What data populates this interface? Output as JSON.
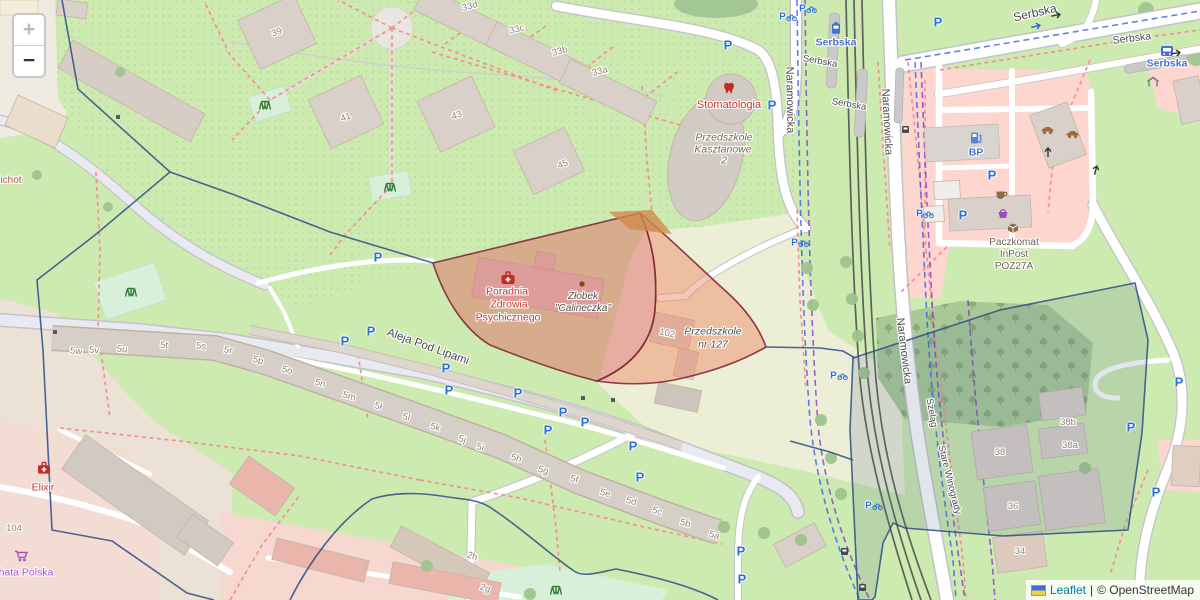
{
  "controls": {
    "zoom_in": "+",
    "zoom_out": "−"
  },
  "attribution": {
    "flag": "ukraine-flag",
    "leaflet": "Leaflet",
    "sep": "|",
    "osm": "© OpenStreetMap"
  },
  "colors": {
    "overlay_red_fill": "#e06666",
    "overlay_red_border": "#82293b",
    "overlay_orange": "#d1894f",
    "boundary_blue": "#2b4d86",
    "boundary_fill": "#5a7290",
    "parking_blue": "#2a6fdb",
    "poi_red": "#c7342e",
    "poi_blue": "#4a6fd0",
    "poi_purple": "#ad4ec1",
    "poi_brown": "#6e6152",
    "edu_text": "#6d6d54",
    "num_text": "#8d8275",
    "street_text": "#4a4a4a",
    "park_green": "#cdebb0",
    "forest_green": "#a9c996",
    "mint_green": "#d8f0da",
    "schoolyard": "#edeed6",
    "building": "#d9d0c9",
    "retail_pink": "#fcd6cf",
    "road_grey": "#e9e9f1",
    "tram_grey": "#5f5f5f",
    "path_red": "#f59090",
    "cycle_blue": "#3355e8",
    "route_purple": "#7733cc",
    "attr_link": "#0078a8"
  },
  "map": {
    "labels": [
      {
        "t": "Aleja Pod Lipami",
        "x": 428,
        "y": 347,
        "r": 20,
        "c": "street",
        "s": 11.5
      },
      {
        "t": "Naramowicka",
        "x": 789,
        "y": 100,
        "r": 89,
        "c": "street"
      },
      {
        "t": "Naramowicka",
        "x": 886,
        "y": 122,
        "r": 87,
        "c": "street"
      },
      {
        "t": "Naramowicka",
        "x": 903,
        "y": 351,
        "r": 83,
        "c": "street"
      },
      {
        "t": "Serbska",
        "x": 1035,
        "y": 13,
        "r": -13,
        "c": "street",
        "s": 12
      },
      {
        "t": "Serbska",
        "x": 1132,
        "y": 39,
        "r": -7,
        "c": "street",
        "s": 10.5
      },
      {
        "t": "Serbska",
        "x": 820,
        "y": 62,
        "r": 10,
        "c": "street",
        "s": 9.5
      },
      {
        "t": "Serbska",
        "x": 849,
        "y": 105,
        "r": 10,
        "c": "street",
        "s": 9.5
      },
      {
        "t": "Szeląg",
        "x": 931,
        "y": 413,
        "r": 80,
        "c": "street",
        "s": 9.5
      },
      {
        "t": "Stare Winogrady",
        "x": 949,
        "y": 480,
        "r": 76,
        "c": "street",
        "s": 9.5
      },
      {
        "t": "Serbska",
        "x": 836,
        "y": 43,
        "r": 0,
        "c": "poi-blue"
      },
      {
        "t": "Serbska",
        "x": 1167,
        "y": 64,
        "r": 0,
        "c": "poi-blue"
      },
      {
        "t": "BP",
        "x": 976,
        "y": 153,
        "r": 0,
        "c": "poi-blue"
      },
      {
        "t": "Stomatologia",
        "x": 729,
        "y": 106,
        "r": 0,
        "c": "poi-red",
        "s": 11
      },
      {
        "t": "ichot",
        "x": 11,
        "y": 181,
        "r": 0,
        "c": "poi-maroon"
      },
      {
        "t": "Elixir",
        "x": 43,
        "y": 488,
        "r": 0,
        "c": "poi-red"
      },
      {
        "t": "hata Polska",
        "x": 26,
        "y": 573,
        "r": 0,
        "c": "poi-purple"
      },
      {
        "t": "Poradnia",
        "x": 507,
        "y": 292,
        "r": 0,
        "c": "overlay-red"
      },
      {
        "t": "Zdrowia",
        "x": 509,
        "y": 305,
        "r": 0,
        "c": "overlay-red"
      },
      {
        "t": "Psychicznego",
        "x": 508,
        "y": 318,
        "r": 0,
        "c": "overlay-red"
      },
      {
        "t": "Żłobek",
        "x": 583,
        "y": 297,
        "r": 0,
        "c": "poi-dark"
      },
      {
        "t": "\"Calineczka\"",
        "x": 583,
        "y": 309,
        "r": 0,
        "c": "poi-dark"
      },
      {
        "t": "Przedszkole",
        "x": 713,
        "y": 332,
        "r": 0,
        "c": "poi-dark",
        "s": 10.5
      },
      {
        "t": "nr 127",
        "x": 713,
        "y": 345,
        "r": 0,
        "c": "poi-dark",
        "s": 10.5
      },
      {
        "t": "Przedszkole",
        "x": 724,
        "y": 138,
        "r": 0,
        "c": "poi-edu"
      },
      {
        "t": "Kasztanowe",
        "x": 723,
        "y": 150,
        "r": 0,
        "c": "poi-edu"
      },
      {
        "t": "2",
        "x": 724,
        "y": 161,
        "r": 0,
        "c": "poi-edu"
      },
      {
        "t": "Paczkomat",
        "x": 1014,
        "y": 243,
        "r": 0,
        "c": "poi-brown"
      },
      {
        "t": "InPost",
        "x": 1014,
        "y": 255,
        "r": 0,
        "c": "poi-brown"
      },
      {
        "t": "POZ27A",
        "x": 1014,
        "y": 267,
        "r": 0,
        "c": "poi-brown"
      },
      {
        "t": "39",
        "x": 277,
        "y": 33,
        "r": -20,
        "c": "num"
      },
      {
        "t": "41",
        "x": 346,
        "y": 118,
        "r": -20,
        "c": "num"
      },
      {
        "t": "43",
        "x": 457,
        "y": 116,
        "r": -20,
        "c": "num"
      },
      {
        "t": "45",
        "x": 563,
        "y": 165,
        "r": -20,
        "c": "num"
      },
      {
        "t": "33d",
        "x": 470,
        "y": 7,
        "r": -15,
        "c": "num"
      },
      {
        "t": "33c",
        "x": 517,
        "y": 30,
        "r": -15,
        "c": "num"
      },
      {
        "t": "33b",
        "x": 560,
        "y": 52,
        "r": -15,
        "c": "num"
      },
      {
        "t": "33a",
        "x": 600,
        "y": 72,
        "r": -15,
        "c": "num"
      },
      {
        "t": "102",
        "x": 667,
        "y": 334,
        "r": 12,
        "c": "num"
      },
      {
        "t": "104",
        "x": 14,
        "y": 529,
        "r": 0,
        "c": "num"
      },
      {
        "t": "5w",
        "x": 76,
        "y": 352,
        "r": 6,
        "c": "num"
      },
      {
        "t": "5v",
        "x": 94,
        "y": 351,
        "r": 6,
        "c": "num"
      },
      {
        "t": "5u",
        "x": 122,
        "y": 350,
        "r": 6,
        "c": "num"
      },
      {
        "t": "5t",
        "x": 164,
        "y": 346,
        "r": 6,
        "c": "num"
      },
      {
        "t": "5s",
        "x": 201,
        "y": 347,
        "r": 8,
        "c": "num"
      },
      {
        "t": "5r",
        "x": 228,
        "y": 351,
        "r": 10,
        "c": "num"
      },
      {
        "t": "5p",
        "x": 258,
        "y": 361,
        "r": 13,
        "c": "num"
      },
      {
        "t": "5o",
        "x": 287,
        "y": 371,
        "r": 14,
        "c": "num"
      },
      {
        "t": "5n",
        "x": 320,
        "y": 384,
        "r": 16,
        "c": "num"
      },
      {
        "t": "5m",
        "x": 349,
        "y": 397,
        "r": 16,
        "c": "num"
      },
      {
        "t": "5ł",
        "x": 378,
        "y": 407,
        "r": 16,
        "c": "num"
      },
      {
        "t": "5l",
        "x": 406,
        "y": 418,
        "r": 16,
        "c": "num"
      },
      {
        "t": "5k",
        "x": 435,
        "y": 428,
        "r": 16,
        "c": "num"
      },
      {
        "t": "5j",
        "x": 462,
        "y": 440,
        "r": 16,
        "c": "num"
      },
      {
        "t": "5i",
        "x": 480,
        "y": 448,
        "r": 16,
        "c": "num"
      },
      {
        "t": "5h",
        "x": 516,
        "y": 459,
        "r": 16,
        "c": "num"
      },
      {
        "t": "5g",
        "x": 543,
        "y": 471,
        "r": 16,
        "c": "num"
      },
      {
        "t": "5f",
        "x": 574,
        "y": 480,
        "r": 16,
        "c": "num"
      },
      {
        "t": "5e",
        "x": 605,
        "y": 494,
        "r": 16,
        "c": "num"
      },
      {
        "t": "5d",
        "x": 631,
        "y": 502,
        "r": 16,
        "c": "num"
      },
      {
        "t": "5c",
        "x": 657,
        "y": 512,
        "r": 16,
        "c": "num"
      },
      {
        "t": "5b",
        "x": 685,
        "y": 524,
        "r": 16,
        "c": "num"
      },
      {
        "t": "5a",
        "x": 714,
        "y": 536,
        "r": 16,
        "c": "num"
      },
      {
        "t": "2h",
        "x": 472,
        "y": 557,
        "r": 18,
        "c": "num"
      },
      {
        "t": "2g",
        "x": 485,
        "y": 589,
        "r": 18,
        "c": "num"
      },
      {
        "t": "38",
        "x": 1000,
        "y": 453,
        "r": 0,
        "c": "num"
      },
      {
        "t": "38b",
        "x": 1068,
        "y": 423,
        "r": 0,
        "c": "num"
      },
      {
        "t": "38a",
        "x": 1070,
        "y": 446,
        "r": 0,
        "c": "num"
      },
      {
        "t": "36",
        "x": 1013,
        "y": 507,
        "r": 0,
        "c": "num"
      },
      {
        "t": "34",
        "x": 1020,
        "y": 552,
        "r": 0,
        "c": "num"
      }
    ],
    "icons": [
      {
        "k": "parking",
        "x": 378,
        "y": 257
      },
      {
        "k": "parking",
        "x": 728,
        "y": 45
      },
      {
        "k": "parking",
        "x": 772,
        "y": 105
      },
      {
        "k": "parking",
        "x": 938,
        "y": 22
      },
      {
        "k": "parking",
        "x": 345,
        "y": 341
      },
      {
        "k": "parking",
        "x": 371,
        "y": 331
      },
      {
        "k": "parking",
        "x": 446,
        "y": 368
      },
      {
        "k": "parking",
        "x": 449,
        "y": 390
      },
      {
        "k": "parking",
        "x": 518,
        "y": 393
      },
      {
        "k": "parking",
        "x": 563,
        "y": 412
      },
      {
        "k": "parking",
        "x": 585,
        "y": 422
      },
      {
        "k": "parking",
        "x": 548,
        "y": 430
      },
      {
        "k": "parking",
        "x": 633,
        "y": 446
      },
      {
        "k": "parking",
        "x": 640,
        "y": 477
      },
      {
        "k": "parking",
        "x": 741,
        "y": 551
      },
      {
        "k": "parking",
        "x": 742,
        "y": 579
      },
      {
        "k": "parking",
        "x": 992,
        "y": 175
      },
      {
        "k": "parking",
        "x": 963,
        "y": 215
      },
      {
        "k": "parking",
        "x": 1179,
        "y": 382
      },
      {
        "k": "parking",
        "x": 1131,
        "y": 427
      },
      {
        "k": "parking",
        "x": 1156,
        "y": 492
      },
      {
        "k": "parking-bike",
        "x": 788,
        "y": 17
      },
      {
        "k": "parking-bike",
        "x": 808,
        "y": 9
      },
      {
        "k": "parking-bike",
        "x": 800,
        "y": 243
      },
      {
        "k": "parking-bike",
        "x": 839,
        "y": 376
      },
      {
        "k": "parking-bike",
        "x": 925,
        "y": 214
      },
      {
        "k": "parking-bike",
        "x": 874,
        "y": 506
      },
      {
        "k": "playground",
        "x": 265,
        "y": 104
      },
      {
        "k": "playground",
        "x": 390,
        "y": 186
      },
      {
        "k": "playground",
        "x": 131,
        "y": 291
      },
      {
        "k": "playground",
        "x": 556,
        "y": 589
      },
      {
        "k": "first-aid",
        "x": 508,
        "y": 278
      },
      {
        "k": "dentist",
        "x": 729,
        "y": 88
      },
      {
        "k": "pharmacy",
        "x": 44,
        "y": 468
      },
      {
        "k": "cart",
        "x": 21,
        "y": 556
      },
      {
        "k": "fuel",
        "x": 976,
        "y": 138
      },
      {
        "k": "cafe",
        "x": 1002,
        "y": 195
      },
      {
        "k": "basket",
        "x": 1003,
        "y": 213
      },
      {
        "k": "parcel",
        "x": 1013,
        "y": 228
      },
      {
        "k": "bus",
        "x": 1167,
        "y": 51
      },
      {
        "k": "tram",
        "x": 836,
        "y": 28
      },
      {
        "k": "shelter",
        "x": 1153,
        "y": 82
      },
      {
        "k": "carwash",
        "x": 1047,
        "y": 130
      },
      {
        "k": "carwash",
        "x": 1072,
        "y": 134
      },
      {
        "k": "arrow",
        "x": 1057,
        "y": 15,
        "r": -12
      },
      {
        "k": "arrow",
        "x": 1177,
        "y": 53,
        "r": -8
      },
      {
        "k": "arrow",
        "x": 1048,
        "y": 151,
        "r": -90
      },
      {
        "k": "arrow",
        "x": 1096,
        "y": 169,
        "r": -75
      },
      {
        "k": "arrow-blue",
        "x": 1037,
        "y": 26,
        "r": -14
      },
      {
        "k": "busstop",
        "x": 845,
        "y": 552
      },
      {
        "k": "busstop",
        "x": 863,
        "y": 588
      },
      {
        "k": "busstop",
        "x": 906,
        "y": 130
      },
      {
        "k": "dot",
        "x": 583,
        "y": 398
      },
      {
        "k": "dot",
        "x": 613,
        "y": 400
      },
      {
        "k": "dot",
        "x": 55,
        "y": 332
      },
      {
        "k": "dot",
        "x": 118,
        "y": 117
      },
      {
        "k": "marker-dot",
        "x": 582,
        "y": 284
      }
    ]
  }
}
